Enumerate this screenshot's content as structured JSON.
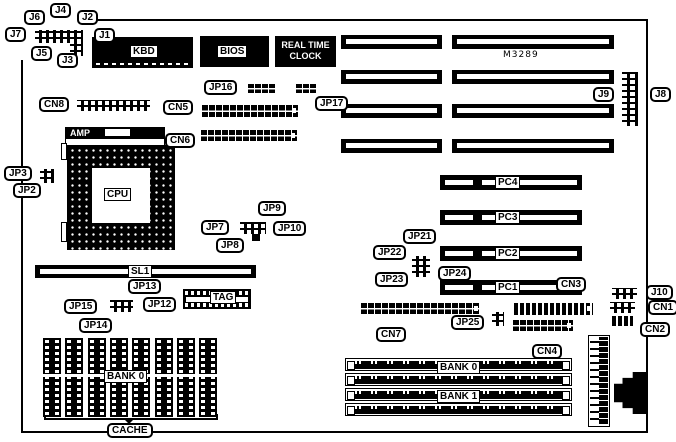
{
  "colors": {
    "ink": "#000000",
    "paper": "#ffffff"
  },
  "board": {
    "model_text": "M3289"
  },
  "blocks": {
    "rtc": {
      "line1": "REAL TIME",
      "line2": "CLOCK"
    },
    "amp": {
      "label": "AMP"
    }
  },
  "box_labels": [
    {
      "id": "kbd",
      "label": "KBD",
      "x": 130,
      "y": 45
    },
    {
      "id": "bios",
      "label": "BIOS",
      "x": 217,
      "y": 45
    },
    {
      "id": "cpu",
      "label": "CPU",
      "x": 104,
      "y": 188
    },
    {
      "id": "sl1",
      "label": "SL1",
      "x": 128,
      "y": 265
    },
    {
      "id": "tag",
      "label": "TAG",
      "x": 210,
      "y": 291
    },
    {
      "id": "cache-bank0",
      "label": "BANK 0",
      "x": 104,
      "y": 370
    },
    {
      "id": "simm-bank0",
      "label": "BANK 0",
      "x": 437,
      "y": 361
    },
    {
      "id": "simm-bank1",
      "label": "BANK 1",
      "x": 437,
      "y": 390
    }
  ],
  "callouts": [
    {
      "label": "J6",
      "x": 24,
      "y": 10,
      "tail": "bottom"
    },
    {
      "label": "J4",
      "x": 50,
      "y": 3,
      "tail": "bottom"
    },
    {
      "label": "J2",
      "x": 77,
      "y": 10,
      "tail": "bottom"
    },
    {
      "label": "J7",
      "x": 5,
      "y": 27,
      "tail": "right"
    },
    {
      "label": "J1",
      "x": 94,
      "y": 28,
      "tail": "left"
    },
    {
      "label": "J5",
      "x": 31,
      "y": 46,
      "tail": "top"
    },
    {
      "label": "J3",
      "x": 57,
      "y": 53,
      "tail": "top"
    },
    {
      "label": "JP16",
      "x": 204,
      "y": 80,
      "tail": "right"
    },
    {
      "label": "JP17",
      "x": 315,
      "y": 96,
      "tail": "top"
    },
    {
      "label": "CN8",
      "x": 39,
      "y": 97,
      "tail": "right"
    },
    {
      "label": "CN5",
      "x": 163,
      "y": 100,
      "tail": "right"
    },
    {
      "label": "CN6",
      "x": 165,
      "y": 133,
      "tail": "right"
    },
    {
      "label": "JP3",
      "x": 4,
      "y": 166,
      "tail": "right"
    },
    {
      "label": "JP2",
      "x": 13,
      "y": 183,
      "tail": "right"
    },
    {
      "label": "JP9",
      "x": 258,
      "y": 201,
      "tail": "bottom"
    },
    {
      "label": "JP7",
      "x": 201,
      "y": 220,
      "tail": "right"
    },
    {
      "label": "JP10",
      "x": 273,
      "y": 221,
      "tail": "left"
    },
    {
      "label": "JP8",
      "x": 216,
      "y": 238,
      "tail": "top"
    },
    {
      "label": "JP13",
      "x": 128,
      "y": 279,
      "tail": "bottom"
    },
    {
      "label": "JP15",
      "x": 64,
      "y": 299,
      "tail": "right"
    },
    {
      "label": "JP12",
      "x": 143,
      "y": 297,
      "tail": "left"
    },
    {
      "label": "JP14",
      "x": 79,
      "y": 318,
      "tail": "top"
    },
    {
      "label": "JP21",
      "x": 403,
      "y": 229,
      "tail": "bottom"
    },
    {
      "label": "JP22",
      "x": 373,
      "y": 245,
      "tail": "right"
    },
    {
      "label": "JP23",
      "x": 375,
      "y": 272,
      "tail": "right"
    },
    {
      "label": "JP24",
      "x": 438,
      "y": 266,
      "tail": "left"
    },
    {
      "label": "CN3",
      "x": 556,
      "y": 277,
      "tail": "bottom"
    },
    {
      "label": "CN7",
      "x": 376,
      "y": 327,
      "tail": "top"
    },
    {
      "label": "JP25",
      "x": 451,
      "y": 315,
      "tail": "right"
    },
    {
      "label": "CN4",
      "x": 532,
      "y": 344,
      "tail": "top"
    },
    {
      "label": "J9",
      "x": 593,
      "y": 87,
      "tail": "right"
    },
    {
      "label": "J8",
      "x": 650,
      "y": 87,
      "tail": "left"
    },
    {
      "label": "J10",
      "x": 646,
      "y": 285,
      "tail": "left"
    },
    {
      "label": "CN1",
      "x": 648,
      "y": 300,
      "tail": "left"
    },
    {
      "label": "CN2",
      "x": 640,
      "y": 322,
      "tail": "left"
    },
    {
      "label": "CACHE",
      "x": 107,
      "y": 423,
      "tail": "top"
    }
  ],
  "isa_slots": {
    "rows": [
      35,
      70,
      104,
      139
    ],
    "cols": [
      {
        "x": 341,
        "w": 101
      },
      {
        "x": 452,
        "w": 162
      }
    ],
    "h": 14
  },
  "pci_geom": {
    "x": 440,
    "w": 142,
    "h": 15
  },
  "pci_slots": [
    {
      "label": "PC4",
      "y": 175
    },
    {
      "label": "PC3",
      "y": 210
    },
    {
      "label": "PC2",
      "y": 246
    },
    {
      "label": "PC1",
      "y": 280
    }
  ],
  "simm_slots": {
    "x": 345,
    "w": 227,
    "h": 13,
    "ys": [
      358,
      373,
      388,
      403
    ]
  },
  "cache_chips": {
    "count": 8,
    "x0": 43,
    "pitch": 22.3,
    "y": 338,
    "w": 18,
    "h": 79
  }
}
